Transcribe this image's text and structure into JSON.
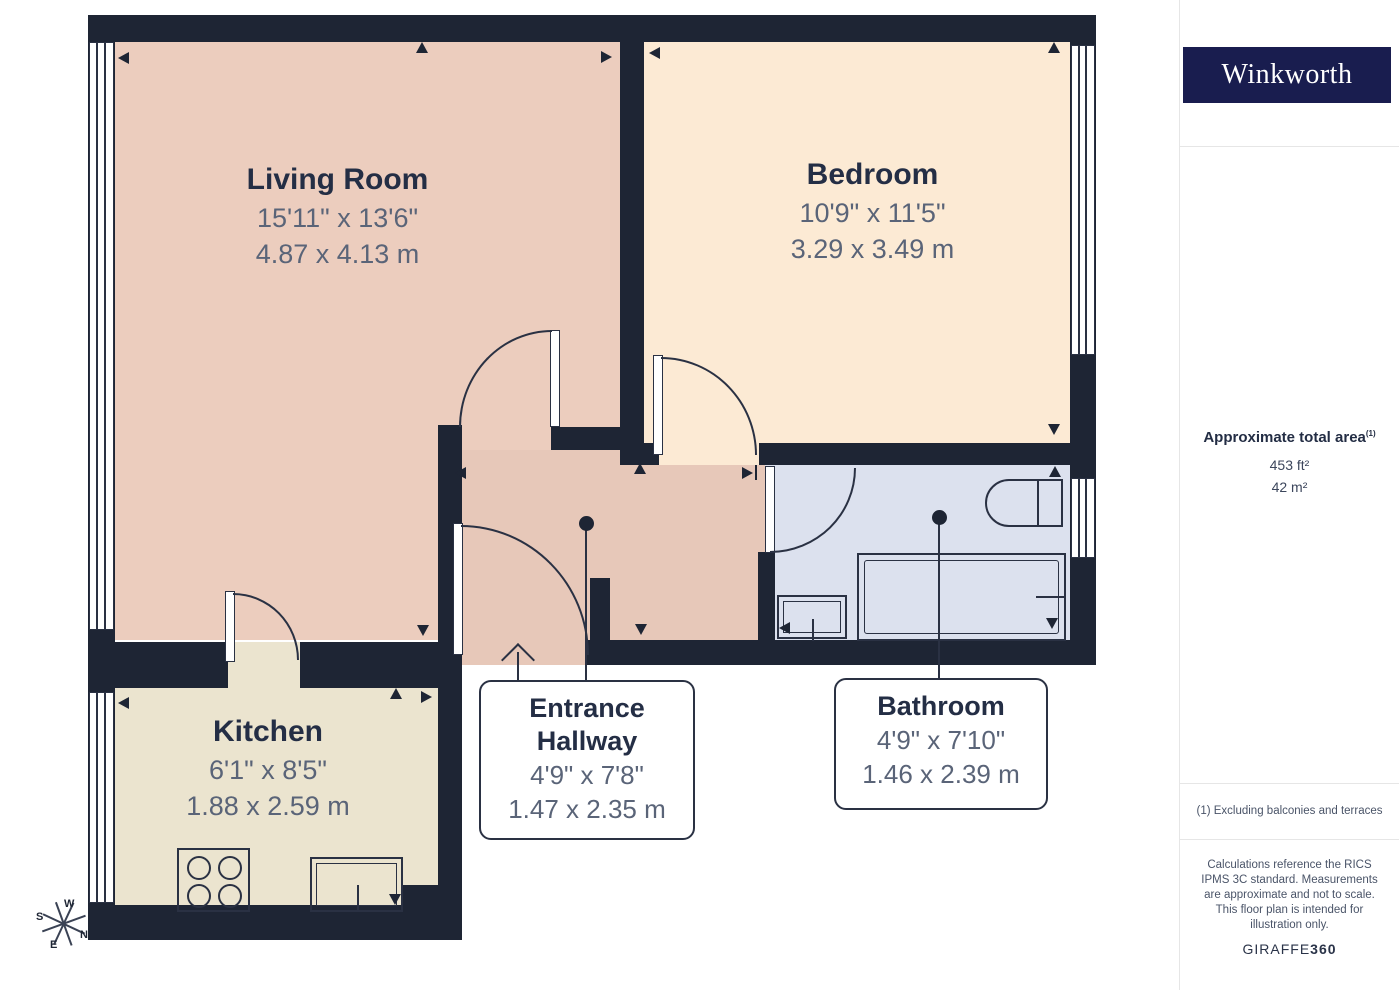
{
  "brand": {
    "logo_text": "Winkworth"
  },
  "sidebar": {
    "area": {
      "title": "Approximate total area",
      "marker": "(1)",
      "imperial": "453 ft²",
      "metric": "42 m²"
    },
    "footnote": "(1) Excluding balconies and terraces",
    "disclaimer": "Calculations reference the RICS IPMS 3C standard. Measurements are approximate and not to scale. This floor plan is intended for illustration only.",
    "credit": {
      "name": "GIRAFFE",
      "suffix": "360"
    }
  },
  "rooms": {
    "living_room": {
      "name": "Living Room",
      "imperial": "15'11\" x 13'6\"",
      "metric": "4.87 x 4.13 m"
    },
    "bedroom": {
      "name": "Bedroom",
      "imperial": "10'9\" x 11'5\"",
      "metric": "3.29 x 3.49 m"
    },
    "kitchen": {
      "name": "Kitchen",
      "imperial": "6'1\" x 8'5\"",
      "metric": "1.88 x 2.59 m"
    },
    "entrance_hallway": {
      "name": "Entrance Hallway",
      "imperial": "4'9\" x 7'8\"",
      "metric": "1.47 x 2.35 m"
    },
    "bathroom": {
      "name": "Bathroom",
      "imperial": "4'9\" x 7'10\"",
      "metric": "1.46 x 2.39 m"
    }
  },
  "compass": {
    "n": "N",
    "s": "S",
    "e": "E",
    "w": "W"
  },
  "colors": {
    "wall": "#1e2534",
    "living_room": "#eccdbe",
    "hallway": "#e7c8b9",
    "bedroom": "#fcead4",
    "kitchen": "#ebe4cf",
    "bathroom": "#dce1ee",
    "brand_navy": "#191d4f"
  }
}
